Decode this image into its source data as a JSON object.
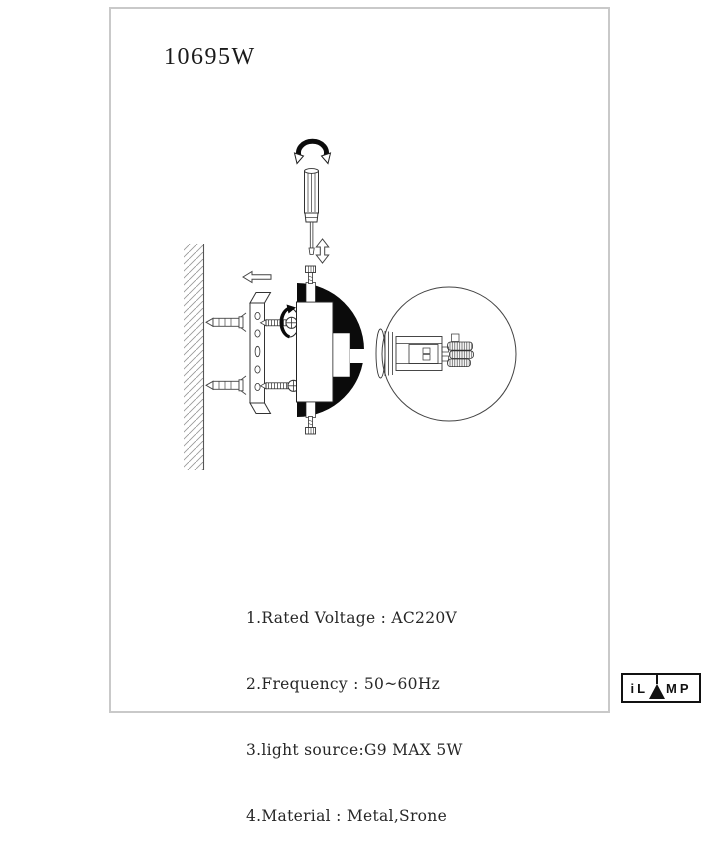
{
  "page": {
    "model_number": "10695W"
  },
  "specs": {
    "lines": [
      "1.Rated Voltage : AC220V",
      "2.Frequency : 50~60Hz",
      "3.light source:G9 MAX 5W",
      "4.Material : Metal,Srone"
    ]
  },
  "logo": {
    "letters_before_mark": "iL",
    "letters_after_mark": "MP",
    "brand_name": "iLAMP"
  },
  "diagram": {
    "type": "wall-lamp-installation-diagram",
    "parts": [
      "twist-direction-arrow",
      "screwdriver",
      "up-down-motion-arrow",
      "wall-section",
      "wall-anchor",
      "push-left-arrow",
      "mounting-bracket",
      "mounting-screw",
      "screw-rotation-arrow",
      "lamp-body",
      "body-fixing-screw",
      "glass-globe",
      "g9-socket",
      "g9-bulb"
    ],
    "colors": {
      "line": "#2a2a2a",
      "solid_fill": "#0b0b0b",
      "page_border": "#c9c9c9"
    }
  }
}
